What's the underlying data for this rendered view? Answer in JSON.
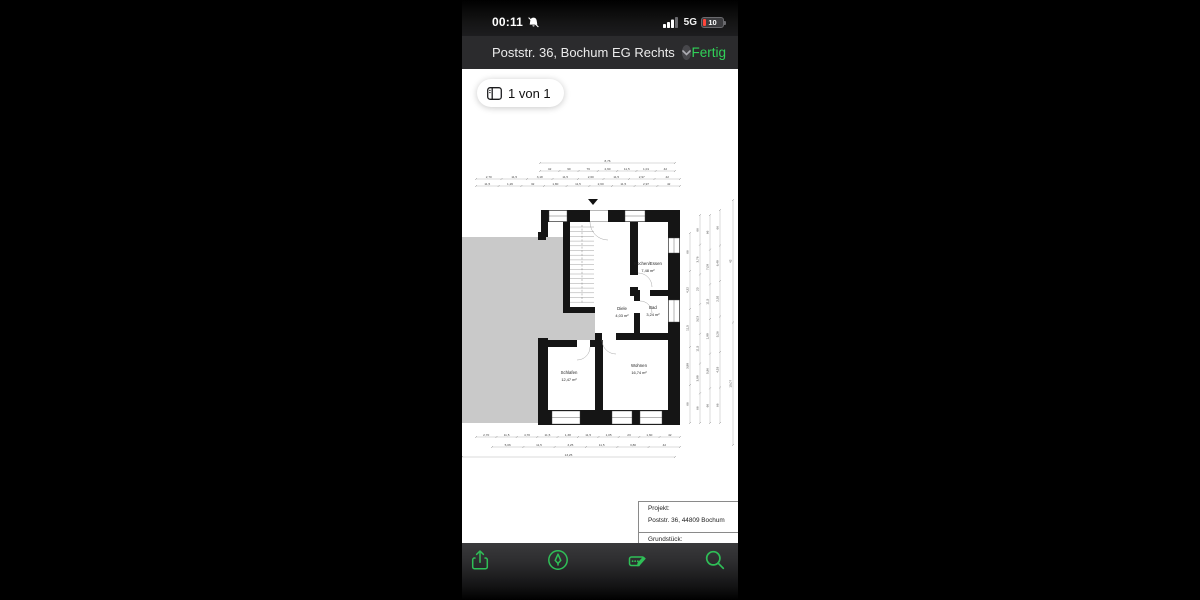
{
  "colors": {
    "accent_green": "#30d158",
    "toolbar_green": "#2fbf57",
    "battery_low_red": "#ff453a",
    "neighbor_gray": "#c9c9c9",
    "nav_bg": "#2b2b2d"
  },
  "status_bar": {
    "time": "00:11",
    "network": "5G",
    "battery_percent": "10",
    "icons": [
      "bell-slash-icon",
      "signal-bars-icon",
      "battery-icon"
    ]
  },
  "nav_bar": {
    "title": "Poststr. 36, Bochum EG Rechts",
    "chevron_icon": "chevron-down-icon",
    "done_label": "Fertig"
  },
  "pager": {
    "icon": "page-thumbnails-icon",
    "label": "1 von 1"
  },
  "floorplan": {
    "rooms": [
      {
        "name": "Kochen/Essen",
        "area": "7,48 m²",
        "x": 186,
        "y": 110
      },
      {
        "name": "Diele",
        "area": "4,03 m²",
        "x": 160,
        "y": 155
      },
      {
        "name": "Bad",
        "area": "3,24 m²",
        "x": 191,
        "y": 154
      },
      {
        "name": "Schlafen",
        "area": "12,47 m²",
        "x": 107,
        "y": 219
      },
      {
        "name": "Wohnen",
        "area": "16,74 m²",
        "x": 177,
        "y": 212
      }
    ],
    "dim_rows": [
      {
        "y": 8,
        "x1": 78,
        "x2": 213,
        "labels": [
          "8,76"
        ]
      },
      {
        "y": 16,
        "x1": 78,
        "x2": 213,
        "labels": [
          "42",
          "90",
          "76",
          "2,60",
          "11,5",
          "1,01",
          "42"
        ]
      },
      {
        "y": 24,
        "x1": 14,
        "x2": 218,
        "labels": [
          "2,70",
          "11,5",
          "3,18",
          "11,5",
          "2,60",
          "11,5",
          "2,97",
          "42"
        ]
      },
      {
        "y": 31,
        "x1": 14,
        "x2": 218,
        "labels": [
          "11,5",
          "1,26",
          "32",
          "1,80",
          "11,5",
          "2,60",
          "11,5",
          "2,97",
          "42"
        ]
      },
      {
        "y": 282,
        "x1": 14,
        "x2": 218,
        "labels": [
          "2,70",
          "11,5",
          "4,70",
          "11,5",
          "1,38",
          "11,5",
          "1,05",
          "23",
          "1,60",
          "42"
        ]
      },
      {
        "y": 292,
        "x1": 30,
        "x2": 218,
        "labels": [
          "5,06",
          "11,5",
          "3,25",
          "11,5",
          "3,80",
          "42"
        ]
      },
      {
        "y": 302,
        "x1": 0,
        "x2": 213,
        "labels": [
          "13,25"
        ]
      }
    ],
    "dim_cols": [
      {
        "x": 228,
        "y1": 78,
        "y2": 268,
        "labels": [
          "66",
          "4,32",
          "11,5",
          "3,88",
          "66"
        ]
      },
      {
        "x": 238,
        "y1": 60,
        "y2": 268,
        "labels": [
          "66",
          "3,76",
          "23",
          "3,03",
          "11,5",
          "3,88",
          "66"
        ]
      },
      {
        "x": 248,
        "y1": 60,
        "y2": 268,
        "labels": [
          "66",
          "7,08",
          "11,5",
          "1,88",
          "5,96",
          "66"
        ]
      },
      {
        "x": 258,
        "y1": 55,
        "y2": 268,
        "labels": [
          "66",
          "6,48",
          "2,92",
          "5,26",
          "4,53",
          "66"
        ]
      },
      {
        "x": 271,
        "y1": 45,
        "y2": 290,
        "labels": [
          "42",
          "15,07"
        ]
      }
    ]
  },
  "title_block": {
    "project_label": "Projekt:",
    "project_value": "Poststr. 36, 44809 Bochum",
    "plot_label": "Grundstück:"
  },
  "toolbar": {
    "icons": [
      "share-icon",
      "markup-pen-icon",
      "autofill-signature-icon",
      "search-icon"
    ]
  }
}
